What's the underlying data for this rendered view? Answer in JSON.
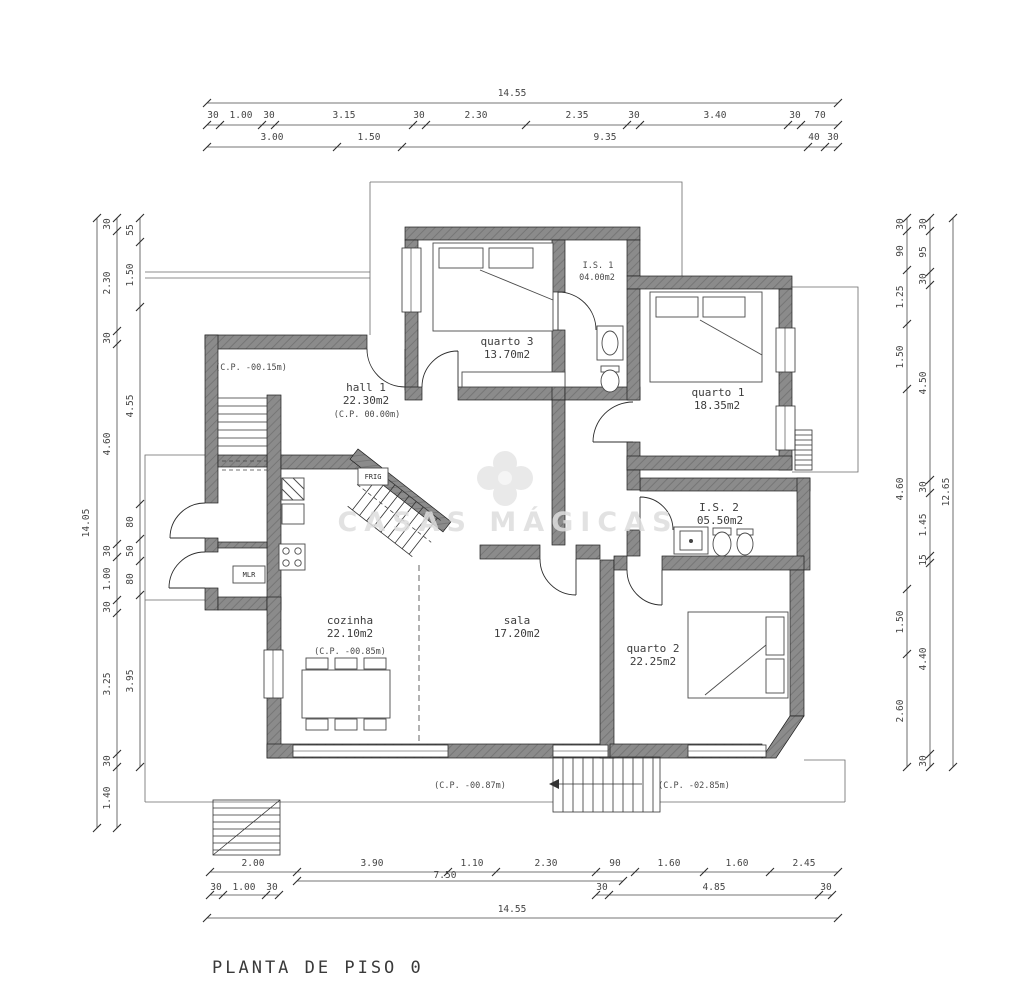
{
  "page": {
    "title": "PLANTA DE PISO 0"
  },
  "watermark": {
    "text": "CASAS MÁGICAS",
    "logo": "clover-icon"
  },
  "colors": {
    "background": "#ffffff",
    "wall": "#8b8b8b",
    "line": "#2e2e2e",
    "dim_text": "#454545",
    "label_text": "#3d3d3d",
    "watermark": "#dedede"
  },
  "rooms": {
    "quarto3": {
      "name": "quarto 3",
      "area": "13.70m2"
    },
    "is1": {
      "name": "I.S. 1",
      "area": "04.00m2"
    },
    "quarto1": {
      "name": "quarto 1",
      "area": "18.35m2"
    },
    "hall1": {
      "name": "hall 1",
      "area": "22.30m2",
      "cp": "(C.P. 00.00m)"
    },
    "is2": {
      "name": "I.S. 2",
      "area": "05.50m2"
    },
    "cozinha": {
      "name": "cozinha",
      "area": "22.10m2",
      "cp": "(C.P. -00.85m)"
    },
    "sala": {
      "name": "sala",
      "area": "17.20m2"
    },
    "quarto2": {
      "name": "quarto 2",
      "area": "22.25m2"
    }
  },
  "annotations": {
    "hall_cp": "(C.P. -00.15m)",
    "stair_cp": "(C.P. -00.87m)",
    "ext_stair_cp": "(C.P. -02.85m)",
    "fridge": "FRIG",
    "washer": "MLR"
  },
  "dims": {
    "top": {
      "overall": "14.55",
      "row2": [
        "30",
        "1.00",
        "30",
        "3.15",
        "30",
        "2.30",
        "2.35",
        "30",
        "3.40",
        "30",
        "70"
      ],
      "row3": [
        "3.00",
        "1.50",
        "9.35",
        "40",
        "30"
      ]
    },
    "bottom": {
      "overall": "14.55",
      "row1": [
        "2.00",
        "3.90",
        "1.10",
        "2.30",
        "90",
        "1.60",
        "1.60",
        "2.45"
      ],
      "sub": "7.50",
      "row2_left": [
        "30",
        "1.00",
        "30"
      ],
      "row2_right": [
        "30",
        "4.85",
        "30"
      ]
    },
    "left": {
      "overall": "14.05",
      "mid": [
        "30",
        "2.30",
        "30",
        "4.60",
        "30",
        "1.00",
        "30",
        "3.25",
        "30",
        "1.40"
      ],
      "inner": [
        "55",
        "1.50",
        "4.55",
        "80",
        "50",
        "80",
        "3.95"
      ]
    },
    "right": {
      "overall": "12.65",
      "inner": [
        "30",
        "90",
        "1.25",
        "1.50",
        "4.60",
        "1.50",
        "2.60"
      ],
      "mid": [
        "30",
        "95",
        "30",
        "4.50",
        "30",
        "1.45",
        "15",
        "4.40",
        "30"
      ]
    }
  }
}
